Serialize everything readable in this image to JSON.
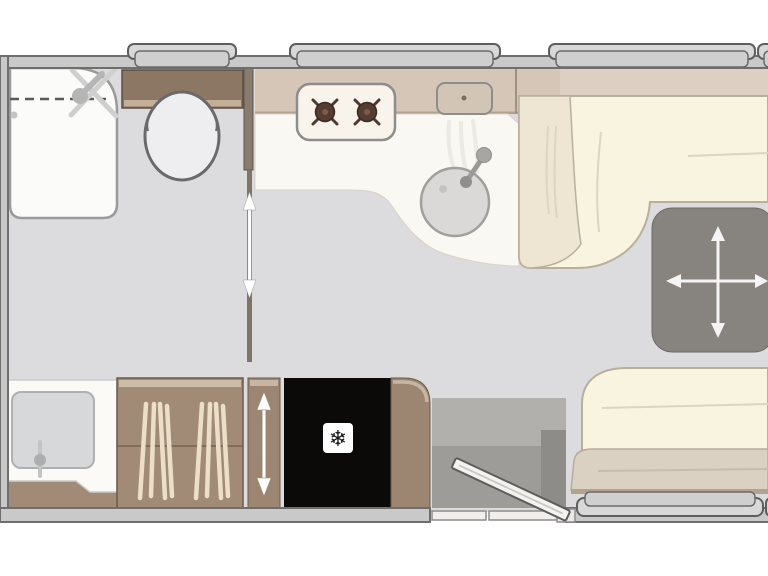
{
  "diagram": {
    "type": "caravan-floorplan",
    "view": "top-down",
    "cut_off_edge": "right"
  },
  "icons": {
    "freezer_snowflake": "❄",
    "table_move_arrows": "four-way-cross-arrows",
    "sliding_door_arrows": "vertical-double-arrow",
    "wardrobe_slide_arrow": "vertical-double-arrow",
    "shower_head": "handset-with-crossed-spray-lines",
    "entrance_door": "open-door-leaf-25deg"
  },
  "colors": {
    "background": "#ffffff",
    "floor": "#dcdbdd",
    "wall_fill": "#c9c9c9",
    "wall_line": "#6e6e6e",
    "window_fill": "#d8d8d8",
    "window_frame": "#5e5e5e",
    "worktop_white": "#faf8f3",
    "counter_band": "#d5c6b8",
    "cabinet_brown": "#a28b76",
    "cabinet_outline": "#6b5a4a",
    "cistern_brown": "#8c7765",
    "seat_cream": "#f8f4df",
    "seat_front_band": "#dbd1c3",
    "table_gray": "#87837f",
    "fridge_black": "#0c0a09",
    "fixture_outline": "#6a6a6a",
    "step_gray": "#9e9c99",
    "arrow_white": "#ffffff"
  },
  "features": {
    "washroom": [
      "shower-tray",
      "shower-head",
      "toilet",
      "washbasin",
      "wardrobe",
      "sliding-door"
    ],
    "kitchen": [
      "two-burner-hob",
      "round-sink-with-tap",
      "worktop",
      "wall-cupboard"
    ],
    "lounge": [
      "l-shaped-sofa",
      "free-standing-table",
      "rear-bench-seat"
    ],
    "entrance": [
      "open-entrance-door",
      "door-threshold",
      "interior-step"
    ],
    "appliances": [
      "fridge-freezer"
    ],
    "windows": [
      "top-window-1",
      "top-window-2",
      "top-window-3",
      "top-window-4-partial",
      "bottom-window"
    ]
  }
}
